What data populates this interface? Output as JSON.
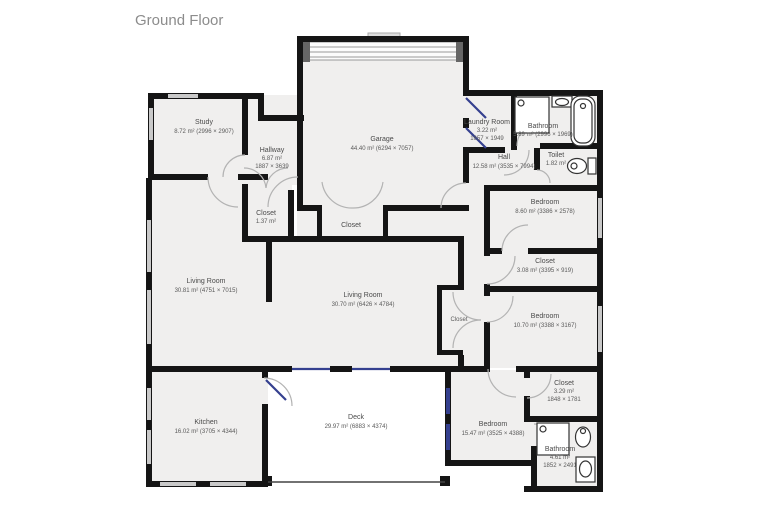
{
  "title": "Ground Floor",
  "colors": {
    "wall": "#151515",
    "room_fill": "#f0efee",
    "window_gray": "#c9c9c9",
    "door_window_blue": "#35408f"
  },
  "rooms": {
    "study": {
      "name": "Study",
      "area": "8.72 m² (2996 × 2907)"
    },
    "hallway": {
      "name": "Hallway",
      "area": "6.87 m²",
      "dims": "1887 × 3639"
    },
    "garage": {
      "name": "Garage",
      "area": "44.40 m² (6294 × 7057)"
    },
    "closet_hallway": {
      "name": "Closet",
      "area": "1.37 m²"
    },
    "closet_garage": {
      "name": "Closet"
    },
    "laundry": {
      "name": "Laundry Room",
      "area": "3.22 m²",
      "dims": "1657 × 1949"
    },
    "bathroom_top": {
      "name": "Bathroom",
      "area": "5.89 m² (2996 × 1969)"
    },
    "hall": {
      "name": "Hall",
      "area": "12.58 m² (3535 × 7994)"
    },
    "toilet": {
      "name": "Toilet",
      "area": "1.82 m²"
    },
    "bedroom_top": {
      "name": "Bedroom",
      "area": "8.60 m² (3386 × 2578)"
    },
    "closet_bedrooms": {
      "name": "Closet",
      "area": "3.08 m² (3395 × 919)"
    },
    "bedroom_middle": {
      "name": "Bedroom",
      "area": "10.70 m² (3388 × 3167)"
    },
    "closet_corridor": {
      "name": "Closet"
    },
    "living_room_left": {
      "name": "Living Room",
      "area": "30.81 m² (4751 × 7015)"
    },
    "living_room_center": {
      "name": "Living Room",
      "area": "30.70 m² (6426 × 4784)"
    },
    "kitchen": {
      "name": "Kitchen",
      "area": "16.02 m² (3705 × 4344)"
    },
    "deck": {
      "name": "Deck",
      "area": "29.97 m² (6883 × 4374)"
    },
    "bedroom_bottom": {
      "name": "Bedroom",
      "area": "15.47 m² (3525 × 4388)"
    },
    "closet_bottom": {
      "name": "Closet",
      "area": "3.29 m²",
      "dims": "1848 × 1781"
    },
    "bathroom_bottom": {
      "name": "Bathroom",
      "area": "4.61 m²",
      "dims": "1852 × 2491"
    }
  }
}
